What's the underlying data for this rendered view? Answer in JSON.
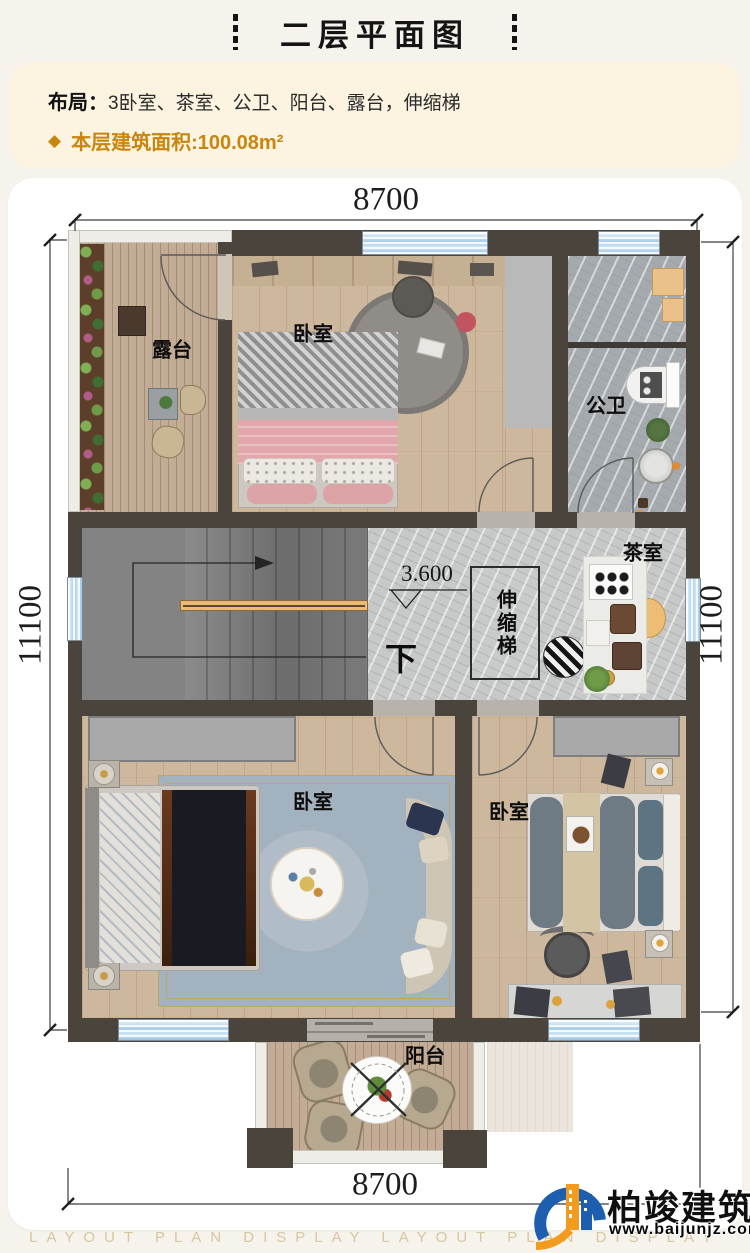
{
  "page": {
    "title": "二层平面图"
  },
  "info": {
    "layout_label": "布局：",
    "layout_value": "3卧室、茶室、公卫、阳台、露台，伸缩梯",
    "area_bullet": "◆",
    "area_text": "本层建筑面积:100.08m²"
  },
  "plan": {
    "dim_top": "8700",
    "dim_bottom": "8700",
    "dim_left": "11100",
    "dim_right": "11100",
    "elevation": "3.600",
    "down_label": "下",
    "rooms": {
      "terrace": "露台",
      "bedroom_top": "卧室",
      "bathroom": "公卫",
      "tearoom": "茶室",
      "ladder": "伸缩梯",
      "bedroom_left": "卧室",
      "bedroom_right": "卧室",
      "balcony": "阳台"
    }
  },
  "logo": {
    "name": "柏竣建筑",
    "site": "www.baijunjz.com"
  },
  "watermark": {
    "text": "LAYOUT PLAN DISPLAY LAYOUT PLAN DISPLAY"
  },
  "colors": {
    "accent_gold": "#c8860e",
    "wall": "#4a443d",
    "window_blue": "#a9cde9",
    "card": "#ffffff"
  }
}
